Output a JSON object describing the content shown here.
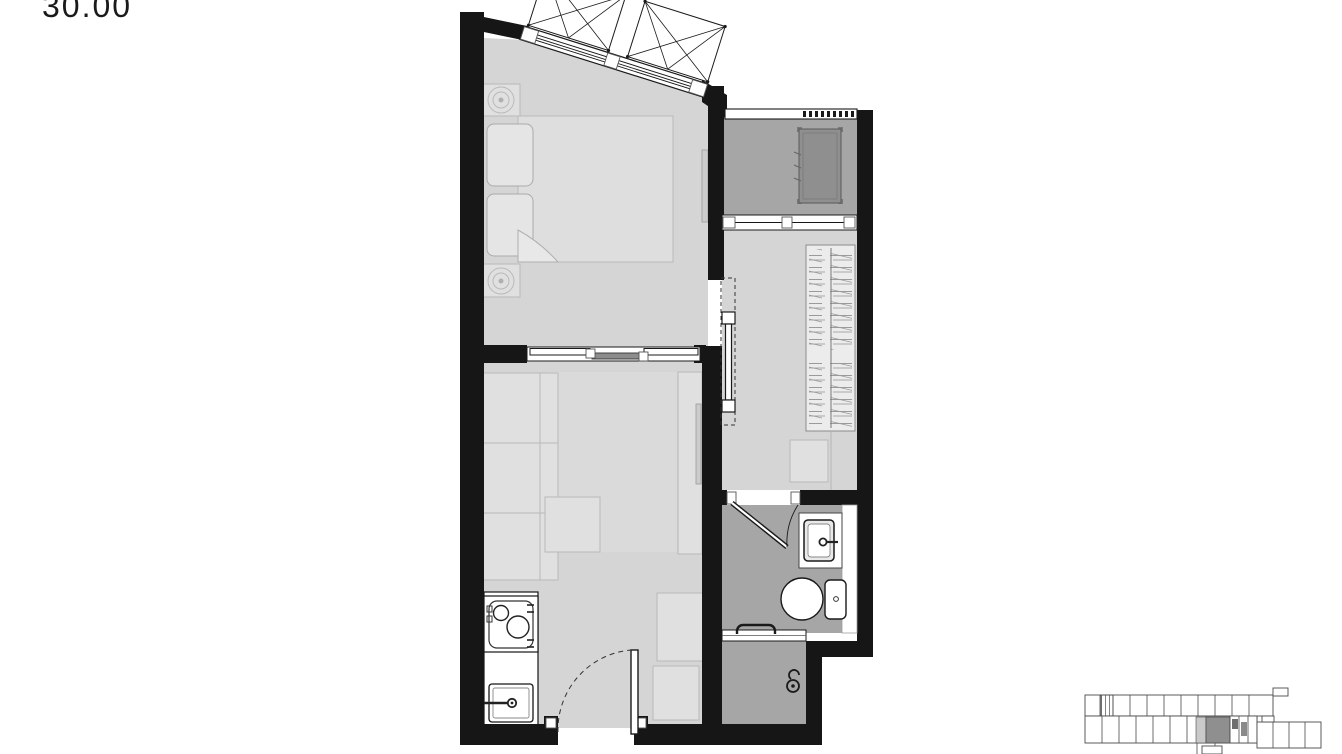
{
  "floorplan": {
    "area_label": "30.00",
    "colors": {
      "wall": "#161616",
      "floor": "#d5d5d5",
      "floor_rug": "#dadada",
      "wet_floor": "#a6a6a6",
      "furniture": "#e0e0e0",
      "furniture_line": "#b9b9b9",
      "white": "#ffffff",
      "condenser": "#8f8f8f",
      "keyplan_line": "#4a4a4a",
      "keyplan_highlight": "#8f8f8f",
      "label_color": "#1a1a1a"
    }
  }
}
